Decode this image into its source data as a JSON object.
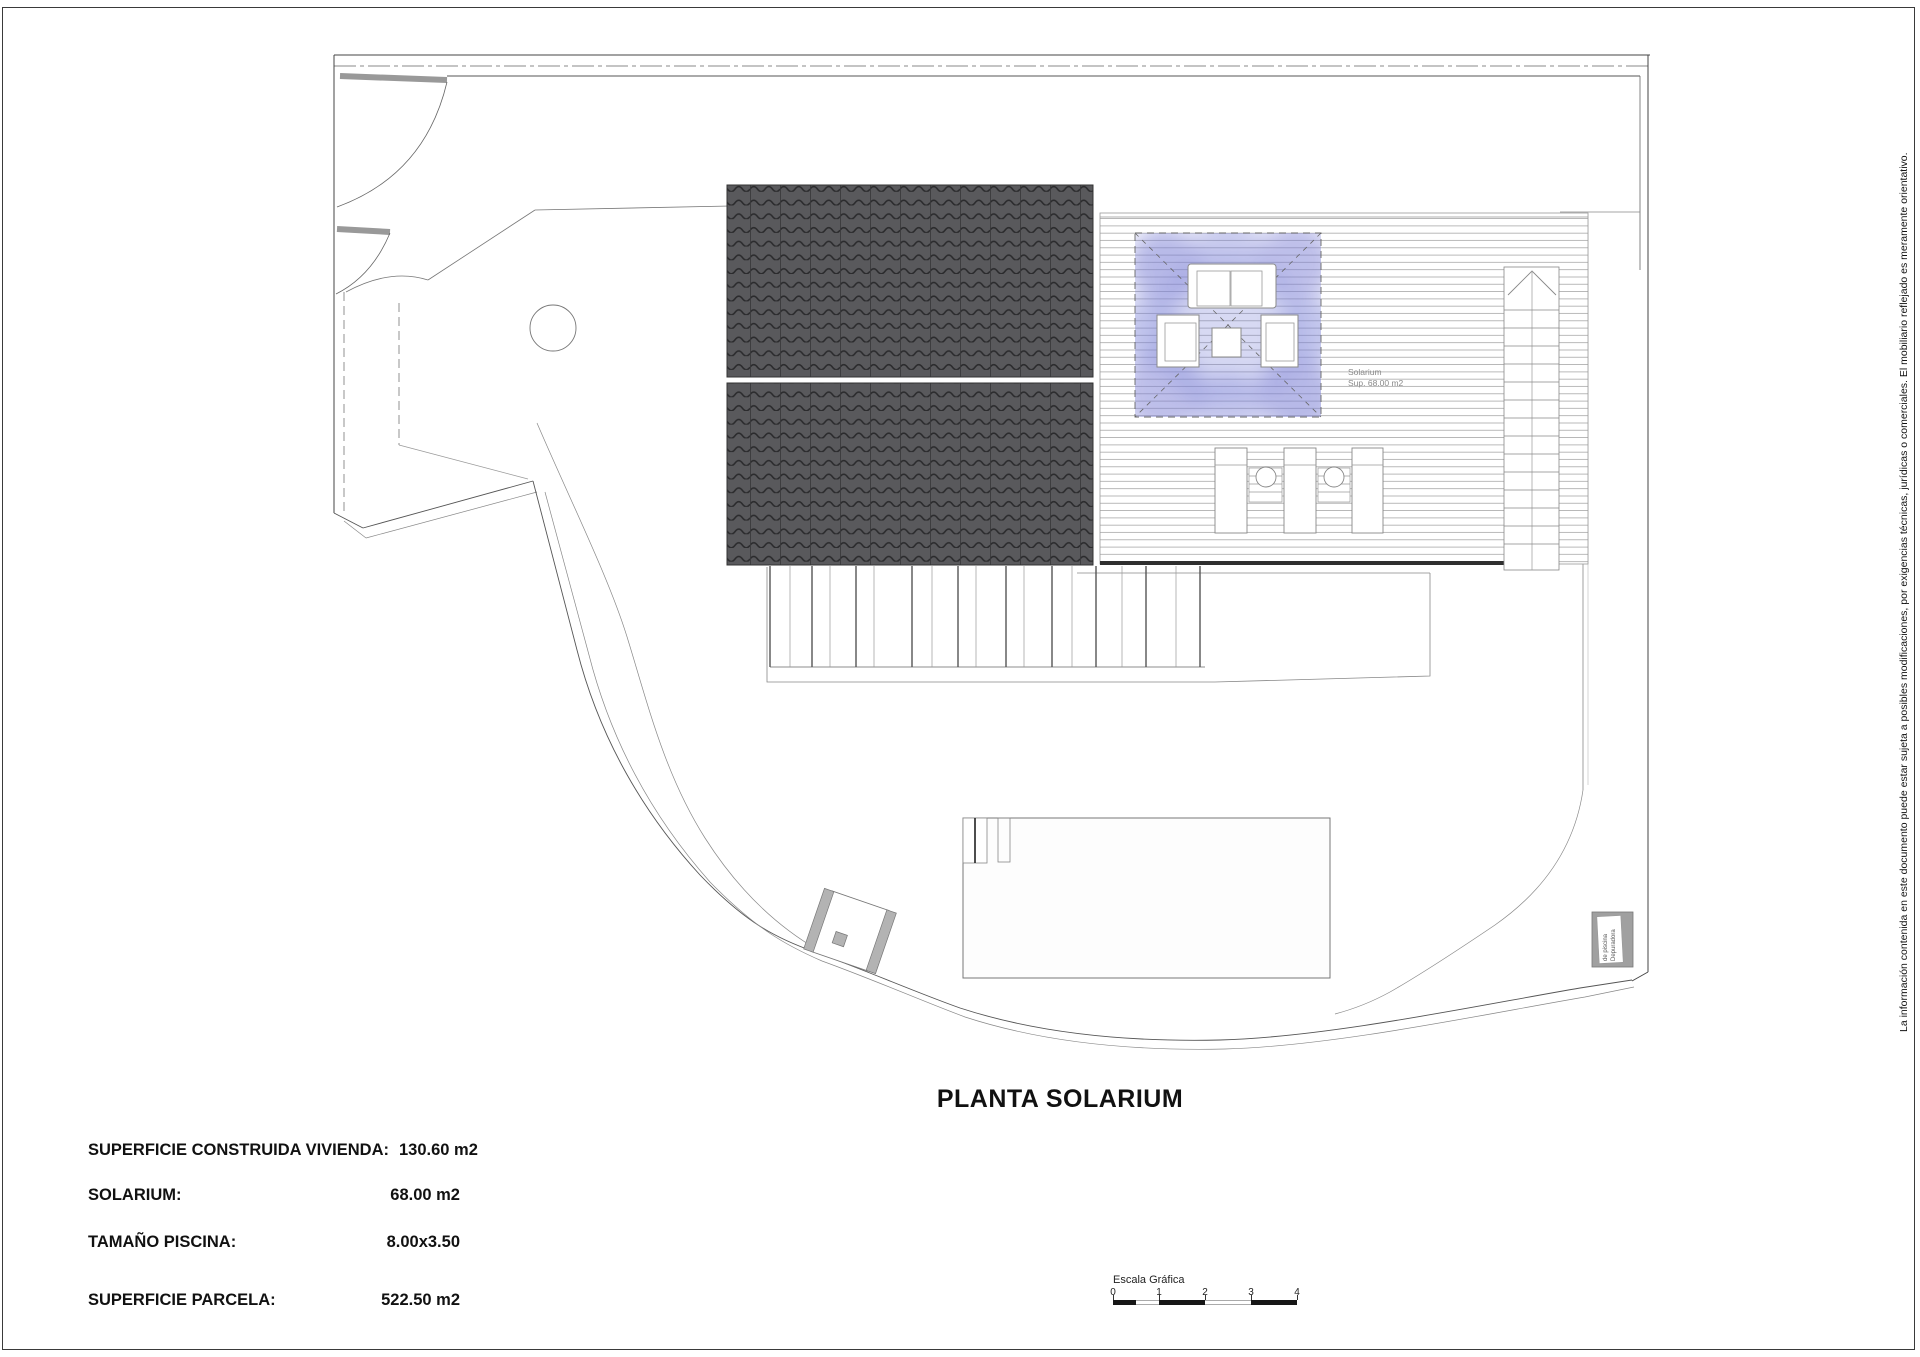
{
  "title": "PLANTA SOLARIUM",
  "disclaimer": "La información contenida en este documento puede estar sujeta a posibles modificaciones, por exigencias técnicas, jurídicas o comerciales. El mobiliario reflejado es meramente orientativo.",
  "info": {
    "rows": [
      {
        "label": "SUPERFICIE CONSTRUIDA VIVIENDA:",
        "value": "130.60 m2"
      },
      {
        "label": "SOLARIUM:",
        "value": "68.00 m2"
      },
      {
        "label": "TAMAÑO PISCINA:",
        "value": "8.00x3.50"
      },
      {
        "label": "SUPERFICIE PARCELA:",
        "value": "522.50 m2"
      }
    ]
  },
  "plan": {
    "solarium_label": {
      "line1": "Solarium",
      "line2": "Sup. 68.00 m2"
    },
    "equipment_label": {
      "line1": "Depuradora",
      "line2": "de piscina"
    }
  },
  "scale": {
    "label": "Escala Gráfica",
    "ticks": [
      "0",
      "1",
      "2",
      "3",
      "4"
    ]
  },
  "colors": {
    "roof_fill": "#59595c",
    "roof_line": "#2b2b2d",
    "solarium_glow": "#7b80d6",
    "boundary_line": "#555555",
    "deck_line": "#a8a8a8"
  }
}
